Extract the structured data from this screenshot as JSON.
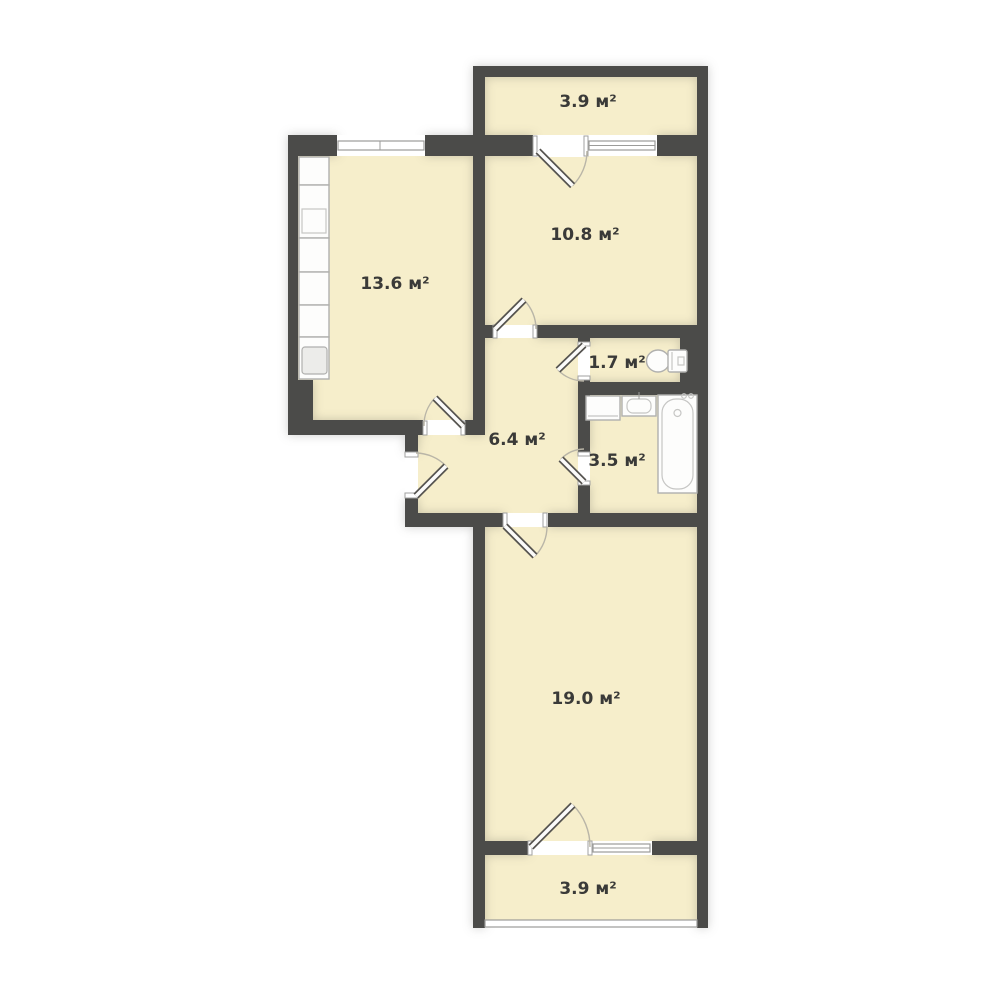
{
  "plan": {
    "type": "floor-plan",
    "unit": "м²",
    "rooms": [
      {
        "key": "balcony_top",
        "label": "3.9 м²",
        "area": 3.9
      },
      {
        "key": "room_10_8",
        "label": "10.8 м²",
        "area": 10.8
      },
      {
        "key": "kitchen_13_6",
        "label": "13.6 м²",
        "area": 13.6
      },
      {
        "key": "wc_1_7",
        "label": "1.7 м²",
        "area": 1.7
      },
      {
        "key": "hall_6_4",
        "label": "6.4 м²",
        "area": 6.4
      },
      {
        "key": "bathroom_3_5",
        "label": "3.5 м²",
        "area": 3.5
      },
      {
        "key": "room_19_0",
        "label": "19.0 м²",
        "area": 19.0
      },
      {
        "key": "balcony_bottom",
        "label": "3.9 м²",
        "area": 3.9
      }
    ],
    "fixtures": [
      "kitchen-counter",
      "stove",
      "kitchen-sink",
      "toilet",
      "washing-machine",
      "bathroom-sink",
      "bathtub"
    ],
    "doors": [
      "balcony-top-door",
      "room-10-8-door",
      "kitchen-door",
      "entrance-door",
      "wc-door",
      "bathroom-door",
      "room-19-door",
      "balcony-bottom-door"
    ],
    "windows": [
      "kitchen-window",
      "balcony-top-window",
      "balcony-bottom-window",
      "balcony-glazing"
    ],
    "colors": {
      "background": "#ffffff",
      "floor": "#f6eecb",
      "wall": "#4b4b49",
      "text": "#3a3a38",
      "fixture_stroke": "#b0b0ae",
      "door_arc": "#b9b5a7"
    }
  }
}
